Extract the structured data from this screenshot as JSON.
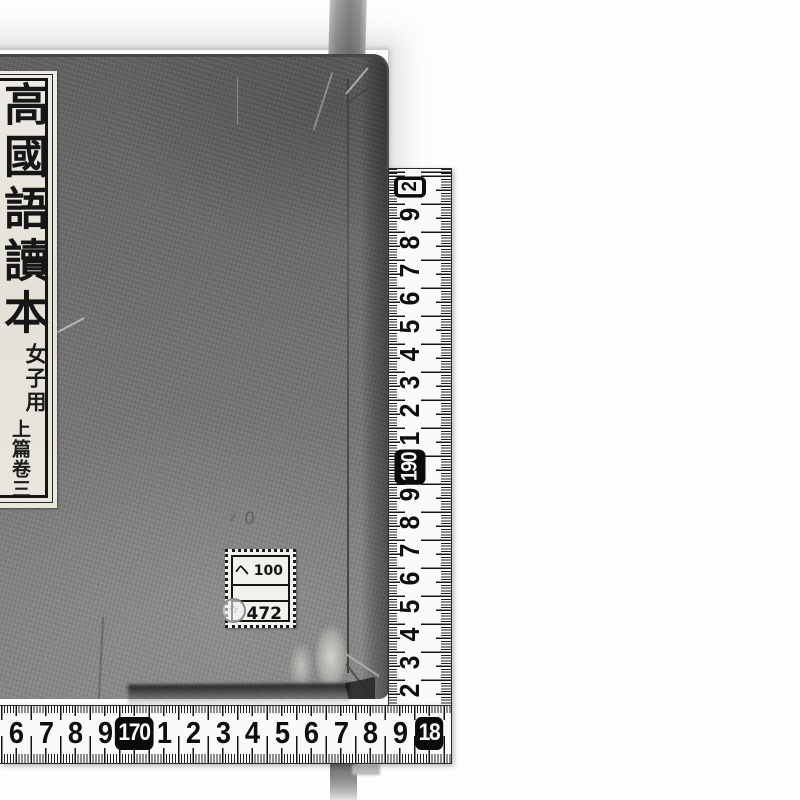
{
  "book": {
    "title_label": {
      "main_title": "高國語讀本",
      "reader_note": "女子用",
      "volume_note": "上篇卷三"
    },
    "stamp_label": {
      "line1": "ヘ 100",
      "line2": "",
      "line3": "472",
      "stamp_glyph": "☆"
    },
    "pencil_mark": "0"
  },
  "tape": {
    "vertical_numbers": [
      {
        "label": "2",
        "boxed": true,
        "outline": true
      },
      {
        "label": "9"
      },
      {
        "label": "8"
      },
      {
        "label": "7"
      },
      {
        "label": "6"
      },
      {
        "label": "5"
      },
      {
        "label": "4"
      },
      {
        "label": "3"
      },
      {
        "label": "2"
      },
      {
        "label": "1"
      },
      {
        "label": "190",
        "boxed": true
      },
      {
        "label": "9"
      },
      {
        "label": "8"
      },
      {
        "label": "7"
      },
      {
        "label": "6"
      },
      {
        "label": "5"
      },
      {
        "label": "4"
      },
      {
        "label": "3"
      },
      {
        "label": "2"
      }
    ],
    "horizontal_numbers": [
      {
        "label": "6"
      },
      {
        "label": "7"
      },
      {
        "label": "8"
      },
      {
        "label": "9"
      },
      {
        "label": "170",
        "boxed": true
      },
      {
        "label": "1"
      },
      {
        "label": "2"
      },
      {
        "label": "3"
      },
      {
        "label": "4"
      },
      {
        "label": "5"
      },
      {
        "label": "6"
      },
      {
        "label": "7"
      },
      {
        "label": "8"
      },
      {
        "label": "9"
      },
      {
        "label": "18",
        "boxed": true
      }
    ]
  },
  "colors": {
    "cover": "#6b6b6b",
    "label_bg": "#e9e6de",
    "tape_bg": "#fafaf8",
    "tick": "#141414",
    "box_bg": "#0b0b0b",
    "box_text": "#f8f8f8"
  }
}
